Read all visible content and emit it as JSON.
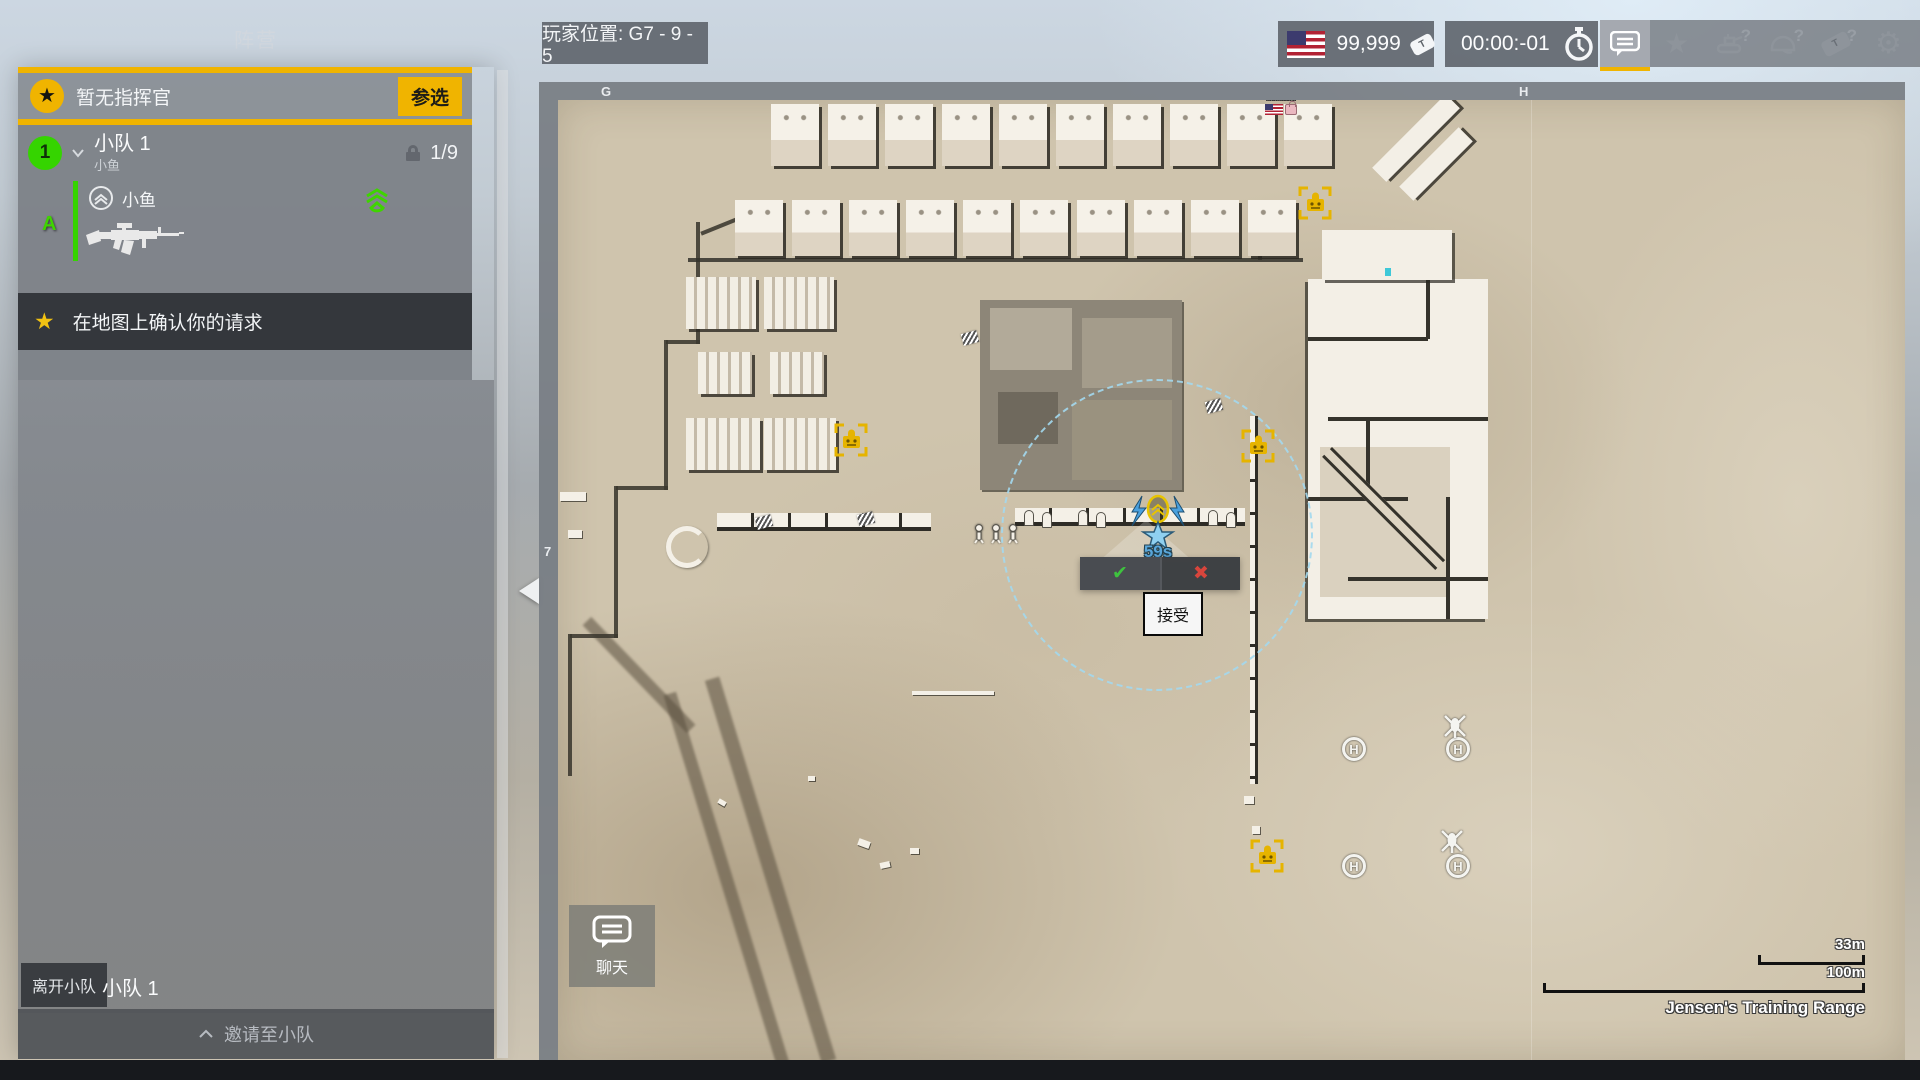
{
  "colors": {
    "accent_yellow": "#f0b400",
    "squad_green": "#35d400",
    "map_sand": "#cfc4ad",
    "hud_gray": "#5e646b"
  },
  "faction_panel": {
    "title": "阵营",
    "commander_row": {
      "no_commander": "暂无指挥官",
      "volunteer": "参选"
    },
    "squad": {
      "number": "1",
      "name": "小队 1",
      "leader_sub": "小鱼",
      "capacity": "1/9"
    },
    "member": {
      "fireteam": "A",
      "name": "小鱼"
    },
    "request_notice": "在地图上确认你的请求",
    "leave_squad": "离开小队",
    "current_squad": "小队 1",
    "invite": "邀请至小队"
  },
  "hud": {
    "player_position": "玩家位置: G7 - 9 - 5",
    "tickets": "99,999",
    "match_timer": "00:00:-01",
    "icons": [
      "chat-icon",
      "commander-star-icon",
      "vehicle-help-icon",
      "infantry-help-icon",
      "ticket-help-icon",
      "settings-gear-icon"
    ]
  },
  "map": {
    "grid_labels": {
      "col_g": "G",
      "col_h": "H",
      "row_7": "7"
    },
    "main_base": "Main",
    "request": {
      "countdown": "59s",
      "accept_tooltip": "接受"
    },
    "chat_button": "聊天",
    "scale": {
      "short": "33m",
      "long": "100m"
    },
    "name": "Jensen's Training Range",
    "markers": {
      "ammo_crates": [
        {
          "x": 293,
          "y": 340
        },
        {
          "x": 700,
          "y": 346
        },
        {
          "x": 757,
          "y": 103
        },
        {
          "x": 709,
          "y": 756
        }
      ],
      "helipads": [
        {
          "x": 796,
          "y": 649
        },
        {
          "x": 900,
          "y": 649
        },
        {
          "x": 796,
          "y": 766
        },
        {
          "x": 900,
          "y": 766
        }
      ],
      "helicopters": [
        {
          "x": 897,
          "y": 626
        },
        {
          "x": 894,
          "y": 741
        }
      ]
    }
  }
}
